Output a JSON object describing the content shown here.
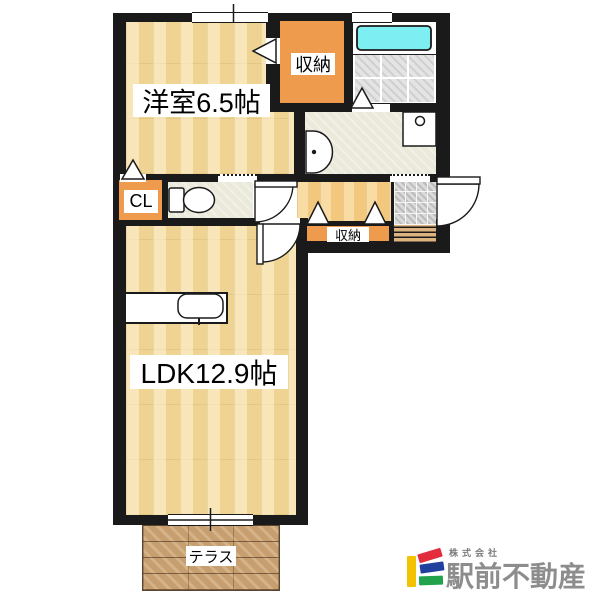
{
  "document_type": "apartment floor plan",
  "rooms": {
    "western_room": "洋室6.5帖",
    "ldk": "LDK12.9帖",
    "storage_top": "収納",
    "storage_hall": "収納",
    "closet": "CL",
    "terrace": "テラス"
  },
  "fixtures": [
    "bathtub",
    "toilet",
    "washbasin",
    "washing-machine-pan",
    "kitchen-sink",
    "entry-steps"
  ],
  "branding": {
    "company_prefix": "株式会社",
    "company_name": "駅前不動産",
    "logo_colors": {
      "yellow": "#f2c300",
      "red": "#e22d3d",
      "blue": "#20409f",
      "green": "#22a24b",
      "text_gray": "#8d8d8d"
    }
  },
  "palette": {
    "wall_black": "#1a1a1a",
    "room_wood": "#efd392",
    "hall_wood": "#f2c87e",
    "storage_orange": "#ef9b4e",
    "washroom_cream": "#ebe9da",
    "bathtub_cyan": "#7deef2",
    "bath_tile_gray": "#e4e4e4",
    "entry_tile_gray": "#dadada",
    "terrace_brick": "#c79e70"
  }
}
